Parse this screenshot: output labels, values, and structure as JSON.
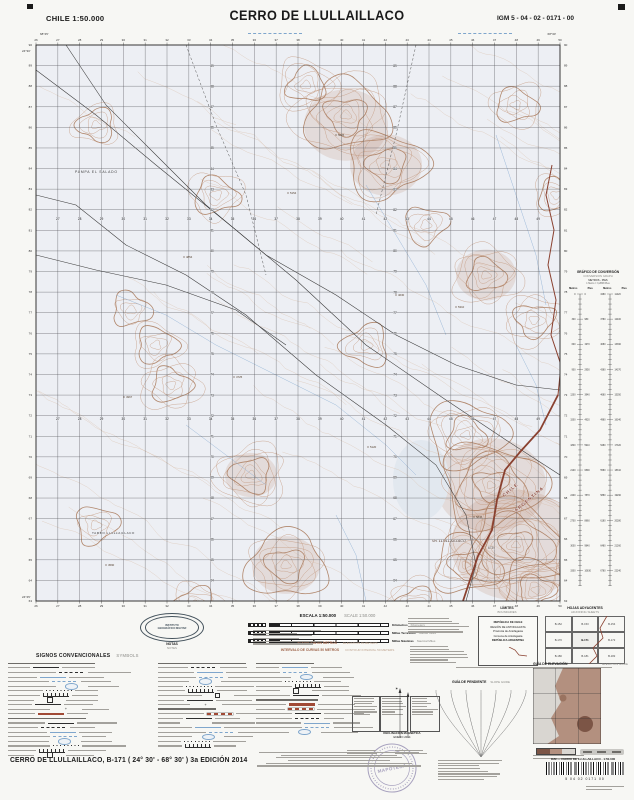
{
  "header": {
    "left": "CHILE  1:50.000",
    "title": "CERRO DE LLULLAILLACO",
    "right": "IGM 5 - 04 - 02 - 0171 - 00"
  },
  "map": {
    "easting_start": 26,
    "easting_end": 50,
    "northing_start": 90,
    "northing_end": 63,
    "corners": {
      "top_left_lon": "68°45'",
      "top_right_lon": "68°30'",
      "top_left_lat": "24°30'",
      "bottom_left_lat": "24°45'"
    },
    "labels": [
      {
        "text": "PAMPA EL SALADO",
        "x": 39,
        "y": 128,
        "size": 3.4,
        "color": "#3a3a3a",
        "ls": 0.8
      },
      {
        "text": "TAMBO LLULLAILLACO",
        "x": 56,
        "y": 489,
        "size": 3.1,
        "color": "#3a3a3a",
        "ls": 0.5
      },
      {
        "text": "Vn. LLULLAILLACO",
        "x": 396,
        "y": 497,
        "size": 3.8,
        "color": "#503626",
        "italic": true
      },
      {
        "text": "6739",
        "x": 452,
        "y": 504,
        "size": 3.2,
        "color": "#503626"
      },
      {
        "text": "CHILE",
        "x": 468,
        "y": 452,
        "size": 4.4,
        "color": "#8a4130",
        "rot": -40,
        "bold": true,
        "ls": 1.2
      },
      {
        "text": "ARGENTINA",
        "x": 480,
        "y": 467,
        "size": 4.4,
        "color": "#8a4130",
        "rot": -40,
        "bold": true,
        "ls": 1.2
      }
    ],
    "spot_heights": [
      {
        "v": "4854",
        "x": 148,
        "y": 212
      },
      {
        "v": "5154",
        "x": 252,
        "y": 148
      },
      {
        "v": "4967",
        "x": 88,
        "y": 352
      },
      {
        "v": "5310",
        "x": 420,
        "y": 262
      },
      {
        "v": "4725",
        "x": 198,
        "y": 332
      },
      {
        "v": "5120",
        "x": 332,
        "y": 402
      },
      {
        "v": "4590",
        "x": 70,
        "y": 520
      },
      {
        "v": "5845",
        "x": 438,
        "y": 472
      },
      {
        "v": "5005",
        "x": 300,
        "y": 90
      },
      {
        "v": "4630",
        "x": 360,
        "y": 250
      }
    ]
  },
  "conversion": {
    "title": "GRÁFICO DE CONVERSIÓN",
    "subtitle": "CONVERSION GRAPH",
    "units": "METROS - PIES",
    "note": "1 Metro = 3,2808 Pies",
    "col1": "Metros",
    "col2": "Pies",
    "col3": "Metros",
    "col4": "Pies"
  },
  "legend": {
    "signos": "SIGNOS CONVENCIONALES",
    "signos_en": "SYMBOLS",
    "notas": "NOTAS",
    "notas_en": "NOTES",
    "escala": "ESCALA 1:50.000",
    "escala_en": "SCALE 1:50.000",
    "bars": [
      {
        "es": "Kilómetros",
        "en": "Kilometers"
      },
      {
        "es": "Millas Terrestres",
        "en": "Statute Miles"
      },
      {
        "es": "Millas Náuticas",
        "en": "Nautical Miles"
      }
    ],
    "elev": "ELEVACIÓN EN METROS",
    "elev_en": "ELEVATION IN METERS",
    "interval": "INTERVALO DE CURVAS 50 METROS",
    "interval_en": "CONTOUR INTERVAL 50 METERS",
    "limites": "LÍMITES",
    "limites_en": "BOUNDARIES",
    "limites_rows": [
      "REPÚBLICA DE CHILE",
      "REGIÓN DE ANTOFAGASTA",
      "Provincia de Antofagasta",
      "Comuna de Antofagasta",
      "REPÚBLICA ARGENTINA"
    ],
    "hojas": "HOJAS ADYACENTES",
    "hojas_en": "ADJOINING SHEETS",
    "hojas_grid": [
      [
        "B-152",
        "B-153",
        "B-154"
      ],
      [
        "B-170",
        "B-171",
        "B-172"
      ],
      [
        "B-180",
        "B-181",
        "B-182"
      ]
    ],
    "guia_pend": "GUÍA DE PENDIENTE",
    "guia_pend_en": "SLOPE GUIDE",
    "guia_elev": "GUÍA DE ELEVACIÓN",
    "guia_elev_en": "ELEVATION GUIDE",
    "decl": "DECLINACIÓN MAGNÉTICA",
    "decl_date": "ENERO 2014",
    "igm_line1": "INSTITUTO",
    "igm_line2": "GEOGRÁFICO MILITAR"
  },
  "footer": {
    "sheet": "CERRO DE LLULLAILLACO, B-171 ( 24° 30' - 68° 30' ) 3a EDICIÓN 2014",
    "stamp": "MAPOTECA",
    "barcode_label": "IGM — CERRO DE LLULLAILLACO - 1:50.000",
    "barcode_digits": "5   04   02   0171   00"
  }
}
